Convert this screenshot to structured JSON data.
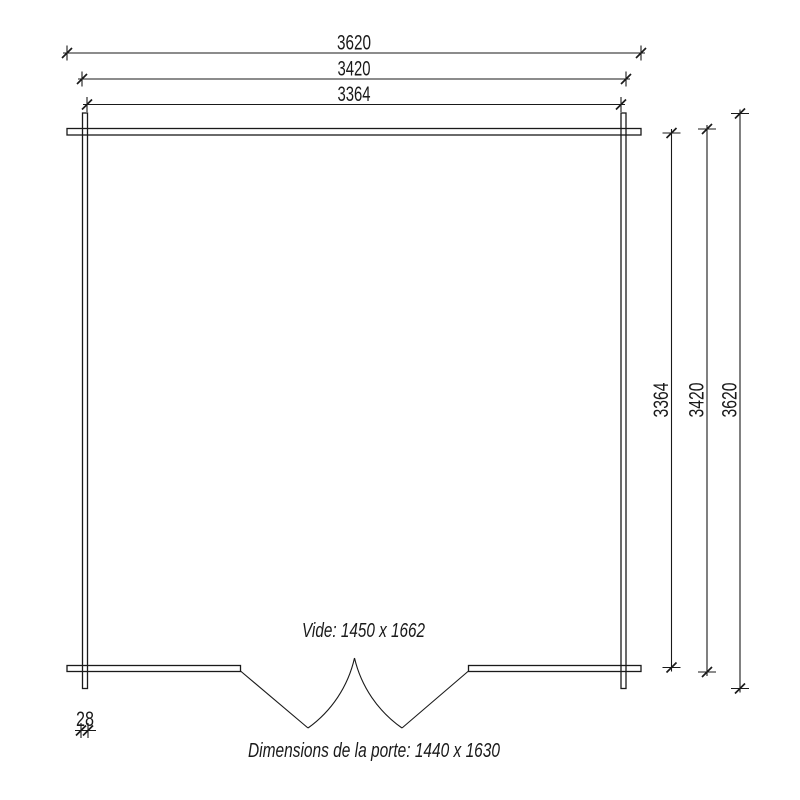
{
  "drawing": {
    "background_color": "#ffffff",
    "line_color": "#1a1a1a",
    "dimensions_top": [
      {
        "label": "3620"
      },
      {
        "label": "3420"
      },
      {
        "label": "3364"
      }
    ],
    "dimensions_right": [
      {
        "label": "3364"
      },
      {
        "label": "3420"
      },
      {
        "label": "3620"
      }
    ],
    "wall_thickness": {
      "label": "28"
    },
    "annotations": {
      "opening_label": "Vide: 1450 x 1662",
      "door_label": "Dimensions de la porte: 1440 x 1630"
    }
  }
}
